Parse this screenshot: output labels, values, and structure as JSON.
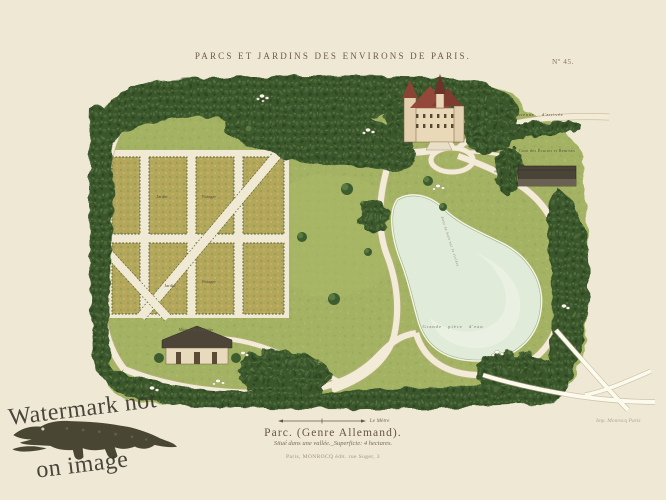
{
  "header": {
    "title": "PARCS ET JARDINS DES ENVIRONS DE PARIS.",
    "plate_number": "Nº 45."
  },
  "plan": {
    "labels": {
      "avenue": "Avenue d'arrivée",
      "cour": "Cour des Écuries et Remises",
      "jardin_top": "Jardin",
      "potager_top": "Potager",
      "jardin_bottom": "Jardin",
      "potager_bottom": "Potager",
      "maison": "Maison du Jardinier",
      "piece_eau": "Grande pièce d'eau",
      "pont": "Pont de bois sur la rivière"
    }
  },
  "caption": {
    "scale_label": "Le Mètre",
    "title": "Parc. (Genre Allemand).",
    "subtitle": "Situé dans une vallée._Superficie: 4 hectares.",
    "publisher": "Paris, MONROCQ édit. rue Suger, 3",
    "printer": "Imp. Monrocq Paris"
  },
  "watermark": {
    "line1": "Watermark not",
    "line2": "on image"
  },
  "palette": {
    "paper": "#eee8d5",
    "lawn": "#a3b363",
    "tree_dark": "#3a572c",
    "path_cream": "#f2ebd7",
    "pond": "#e1ebd9",
    "plot_olive": "#b4a65a",
    "roof_red": "#8f4438"
  }
}
